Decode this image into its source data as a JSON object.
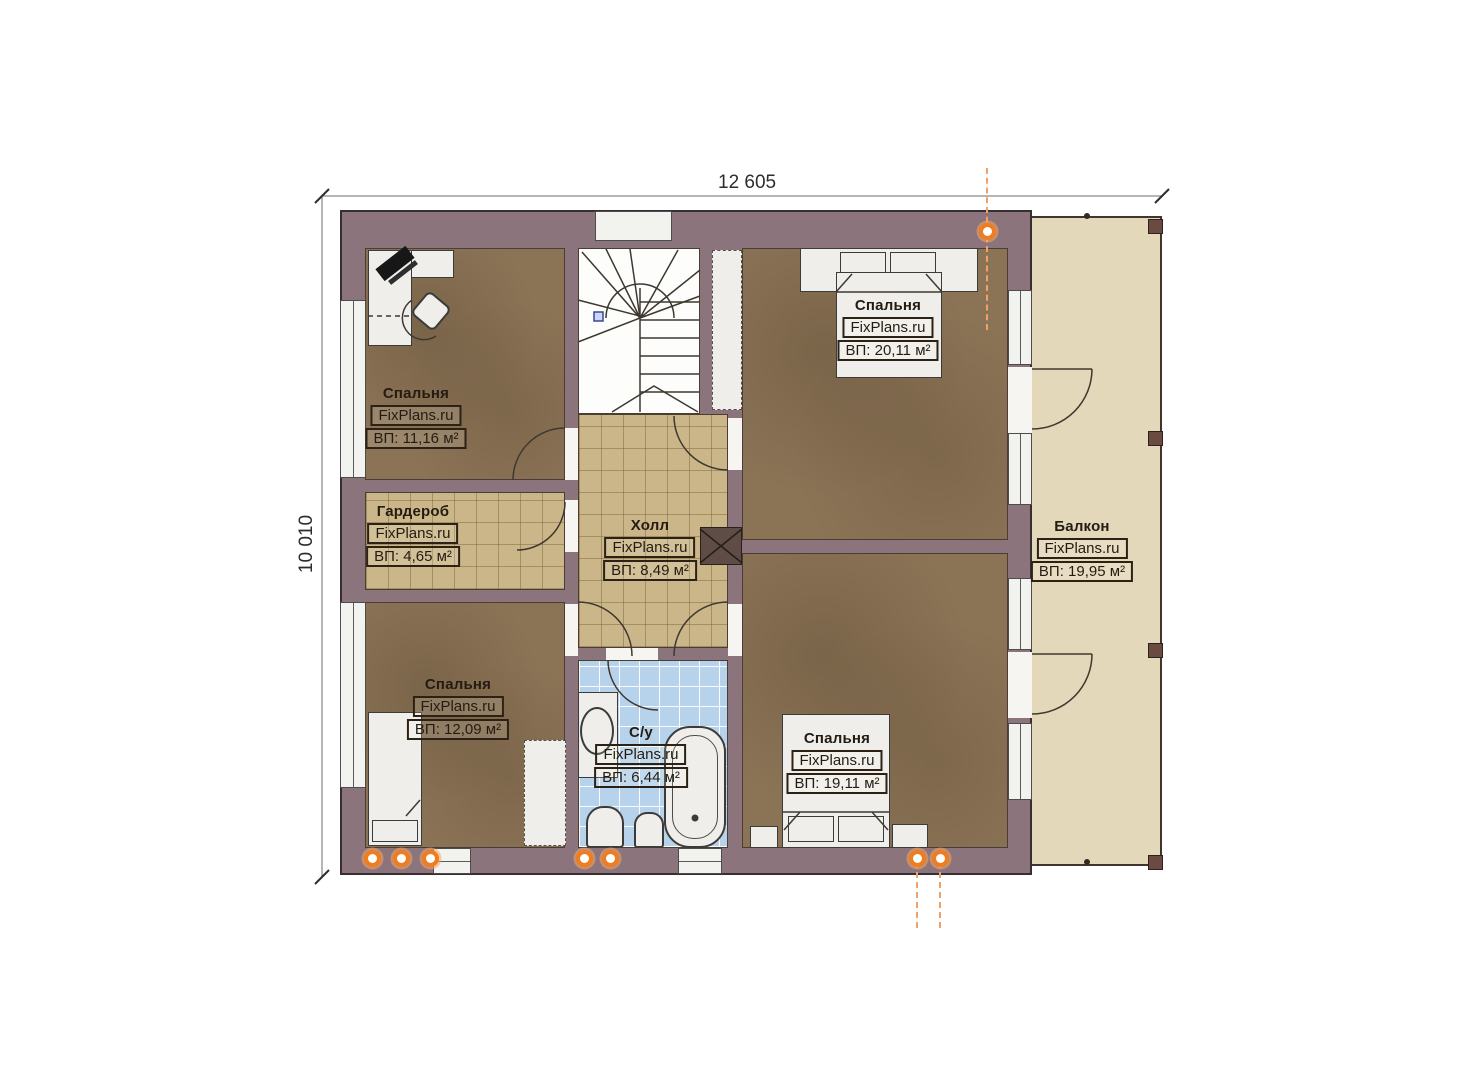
{
  "watermark": "FixPlans.ru",
  "dimensions": {
    "width": "12 605",
    "height": "10 010"
  },
  "rooms": [
    {
      "name": "Спальня",
      "brand": "FixPlans.ru",
      "area": "ВП: 11,16 м²"
    },
    {
      "name": "Гардероб",
      "brand": "FixPlans.ru",
      "area": "ВП: 4,65 м²"
    },
    {
      "name": "Спальня",
      "brand": "FixPlans.ru",
      "area": "ВП: 12,09 м²"
    },
    {
      "name": "Холл",
      "brand": "FixPlans.ru",
      "area": "ВП: 8,49 м²"
    },
    {
      "name": "С/у",
      "brand": "FixPlans.ru",
      "area": "ВП: 6,44 м²"
    },
    {
      "name": "Спальня",
      "brand": "FixPlans.ru",
      "area": "ВП: 20,11 м²"
    },
    {
      "name": "Спальня",
      "brand": "FixPlans.ru",
      "area": "ВП: 19,11 м²"
    },
    {
      "name": "Балкон",
      "brand": "FixPlans.ru",
      "area": "ВП: 19,95 м²"
    }
  ],
  "colors": {
    "wall": "#8c747c",
    "room_floor": "#8b7356",
    "tile_floor": "#cbb689",
    "bath_floor": "#b7d3ec",
    "balcony_floor": "#e4d8ba",
    "marker_orange": "#ee7d22"
  }
}
